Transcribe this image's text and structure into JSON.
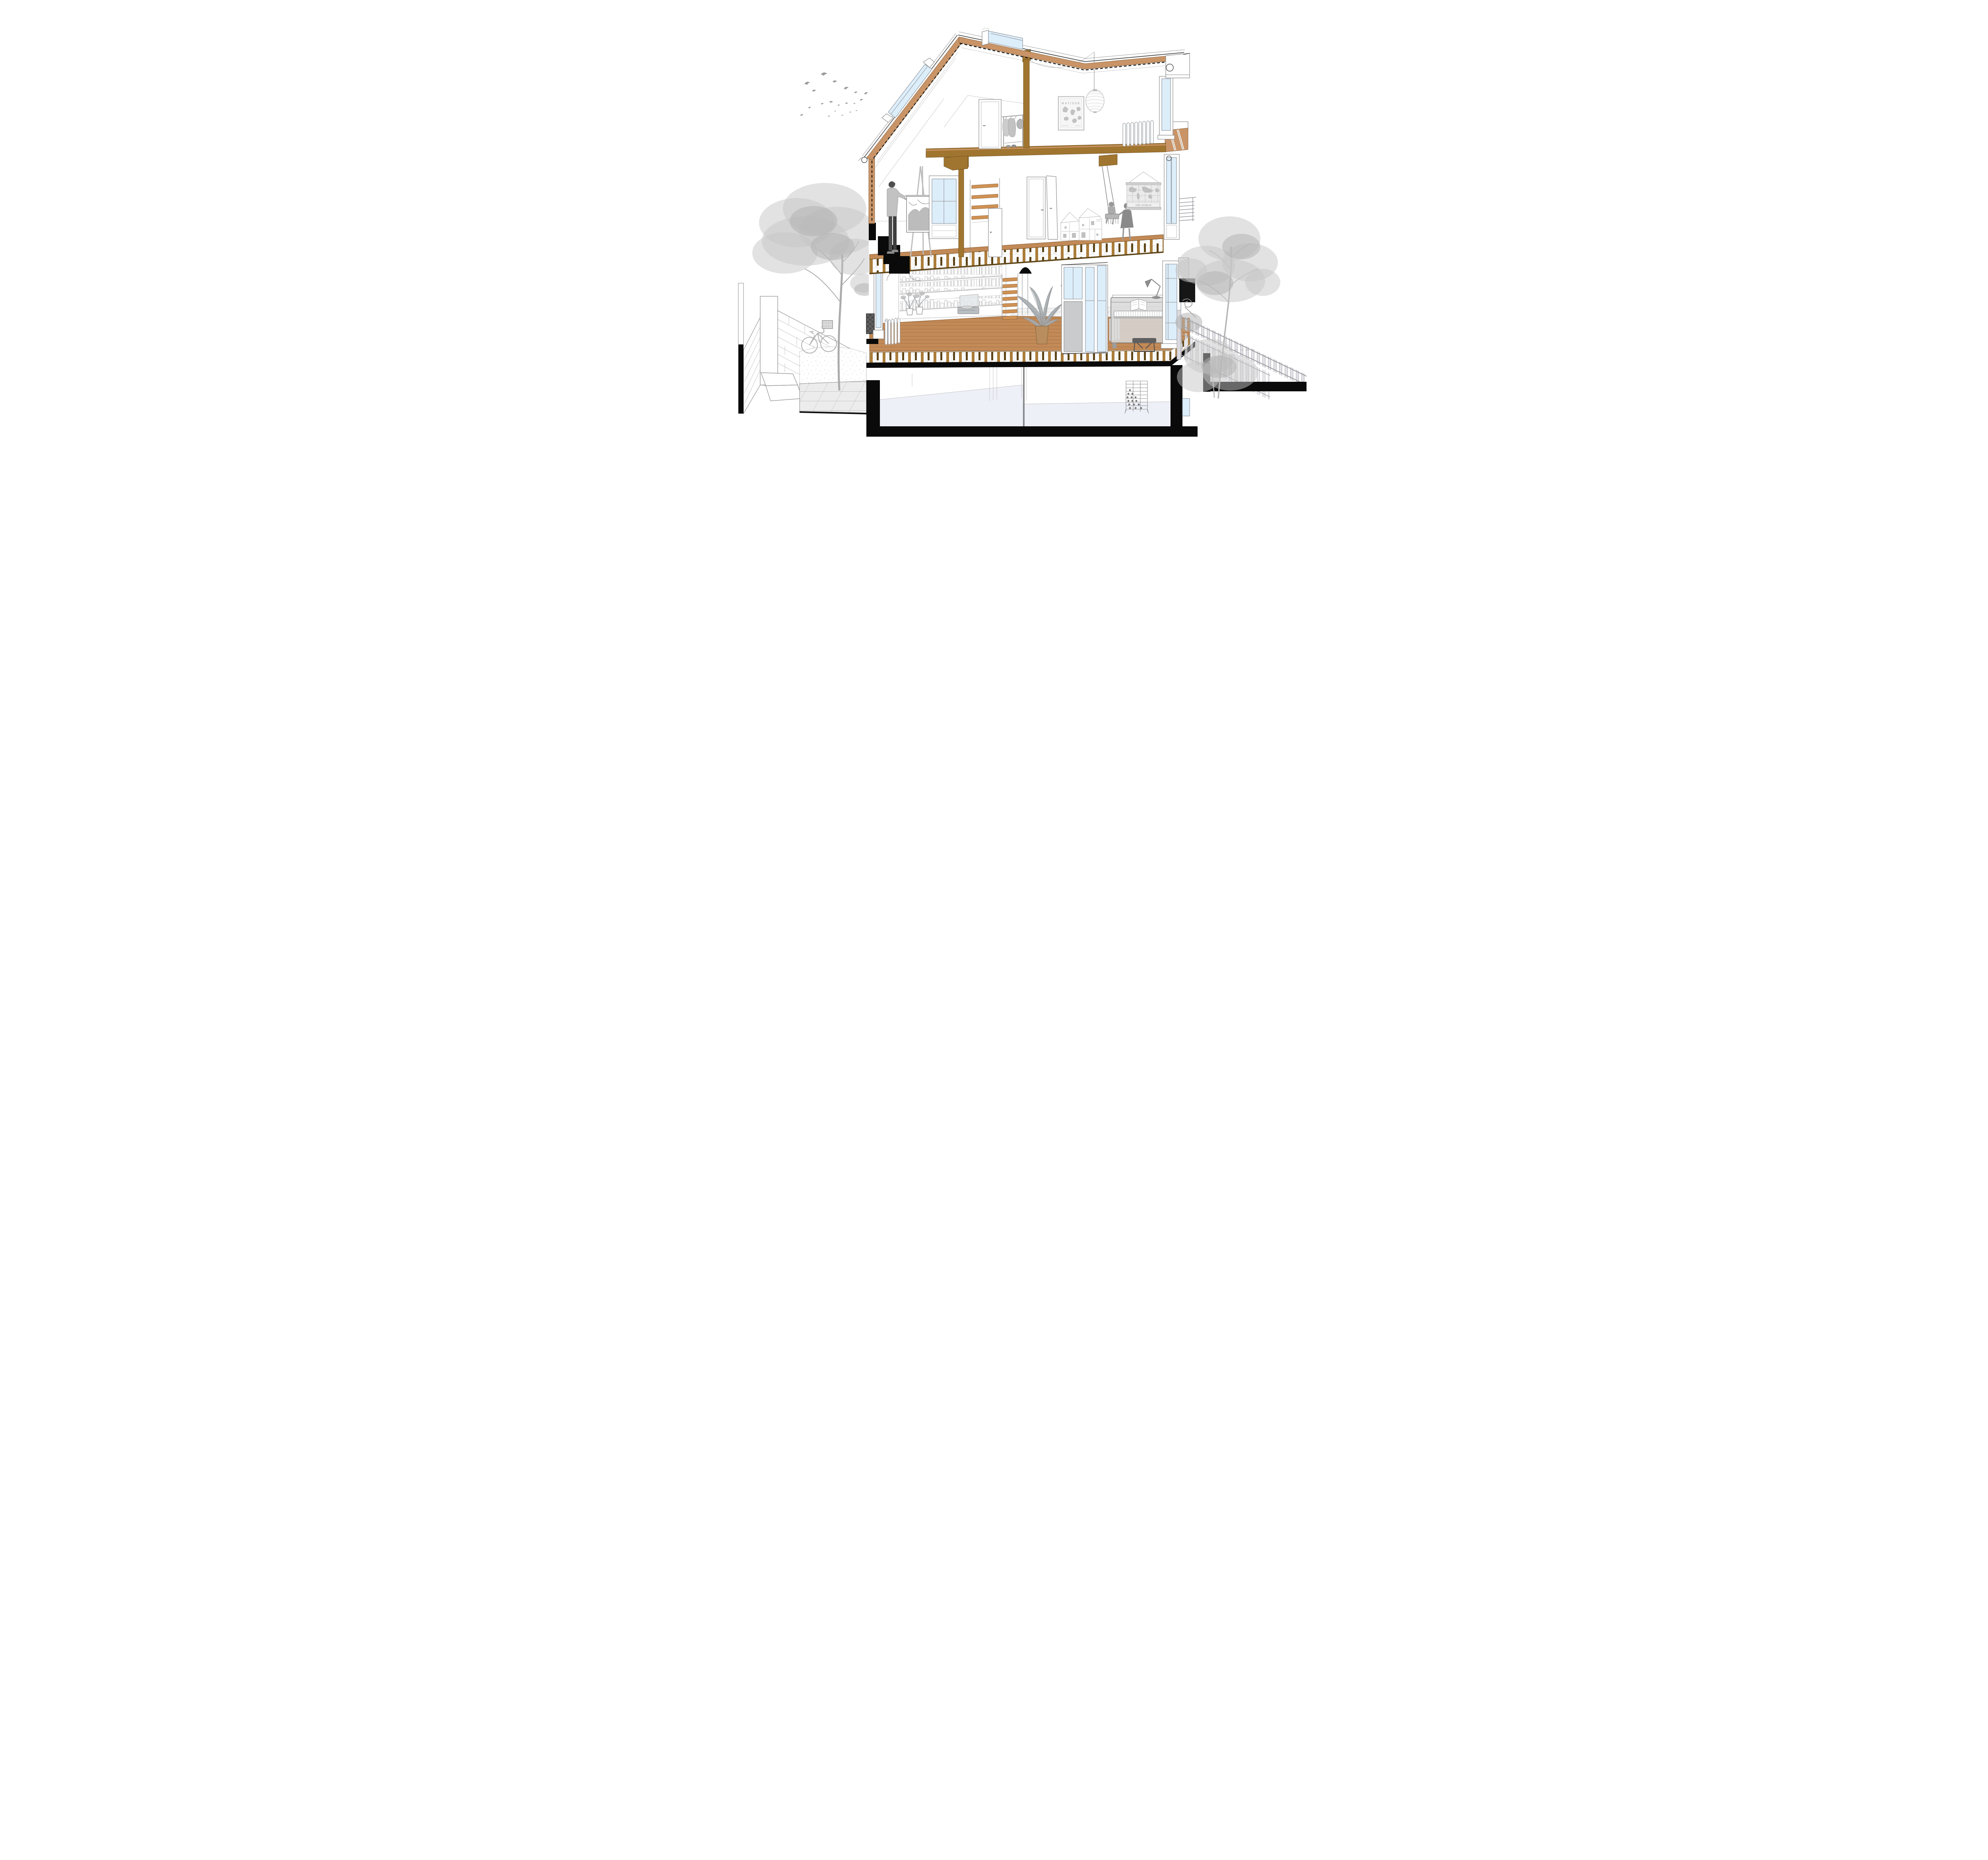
{
  "meta": {
    "kind": "architectural cross-section illustration",
    "subject": "Sectional perspective of a three-storey house with attic, basement, front yard and rear garden"
  },
  "texts": {
    "poster_title": "MATISSE",
    "map_title": "THE WORLD"
  },
  "palette": {
    "paper": "#ffffff",
    "poche": "#0a0a0a",
    "timber_beam": "#a0752f",
    "timber_joist": "#ab7d3a",
    "timber_joist_dark": "#5e4517",
    "roof_infill": "#c99467",
    "wood_floor": "#c28a57",
    "stair_tread": "#cf9254",
    "glass": "#ddeefb",
    "basement_floor": "#eef0f8",
    "furniture_gray": "#b9b9b9",
    "foliage_gray": "#c6c6c6",
    "partition_panel": "#c9cbcd"
  },
  "scene": {
    "sky": [
      "flock-of-birds"
    ],
    "front_yard_left": [
      "garden-brick-wall",
      "gate-pier",
      "black-retaining-wall",
      "garden-steps",
      "tiled-path",
      "gravel-bed",
      "bicycle-with-basket",
      "large-tree"
    ],
    "attic": [
      "skylight-left-slope",
      "skylight-ridge",
      "bedroom-door",
      "clothes-rack",
      "timber-post",
      "matisse-poster",
      "paper-lantern-pendant",
      "radiator",
      "right-window"
    ],
    "middle_floor": [
      "painter-at-easel",
      "tall-window",
      "timber-post-with-corbel",
      "stair-to-attic",
      "stair-door",
      "hallway-door-closed",
      "hallway-door-open",
      "dollhouse-with-toys",
      "hanging-swing-with-toddler",
      "girl-pushing-swing",
      "world-map-poster",
      "glazed-door-right",
      "juliet-balcony-rods",
      "sectioned-cornice"
    ],
    "ground_floor": [
      "left-window",
      "window-guard-grille",
      "radiator-left",
      "full-wall-bookshelf",
      "potted-plants",
      "record-player",
      "stair-to-middle-floor",
      "tiled-hallway-floor",
      "eames-coat-rack",
      "banana-plant-in-pot",
      "glazed-interior-partition",
      "partition-radiator",
      "upright-piano",
      "sheet-music",
      "desk-lamp",
      "piano-bench",
      "bay-window"
    ],
    "basement": [
      "wine-rack",
      "central-pipe",
      "foundation-slab"
    ],
    "garden_right": [
      "picket-fence",
      "iron-scroll-bracket",
      "tall-tree",
      "shrub-tree",
      "black-retaining-wall"
    ]
  },
  "structure": {
    "floors": [
      "basement",
      "ground floor",
      "first floor",
      "attic"
    ],
    "section_conventions": [
      "black poché cut walls",
      "tan insulation in roof build-up",
      "exposed timber joists with scalloped infill",
      "dashed membrane line along roof"
    ]
  }
}
